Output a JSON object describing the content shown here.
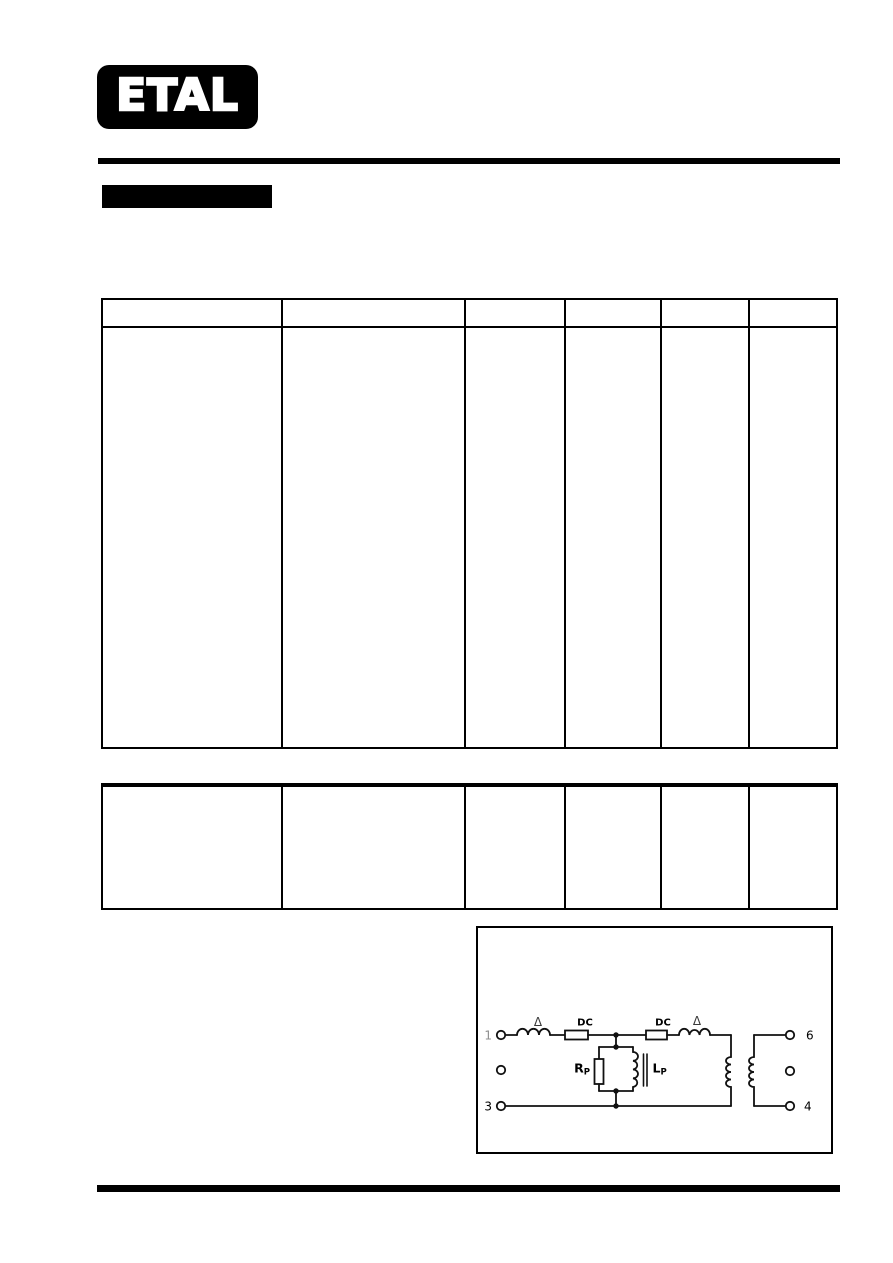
{
  "page": {
    "background": "#ffffff",
    "ink": "#000000"
  },
  "logo": {
    "text": "ETAL"
  },
  "diagram": {
    "pins": {
      "p1": "1",
      "p3": "3",
      "p6": "6",
      "p4": "4"
    },
    "labels": {
      "delta_left": "Δ",
      "dc_left": "DC",
      "dc_right": "DC",
      "delta_right": "Δ",
      "r_main": "R",
      "r_sub": "P",
      "l_main": "L",
      "l_sub": "P"
    },
    "colors": {
      "pin1_gray": "#8f8f8f",
      "delta_ink": "#3a3a3a",
      "ink": "#000000"
    }
  }
}
